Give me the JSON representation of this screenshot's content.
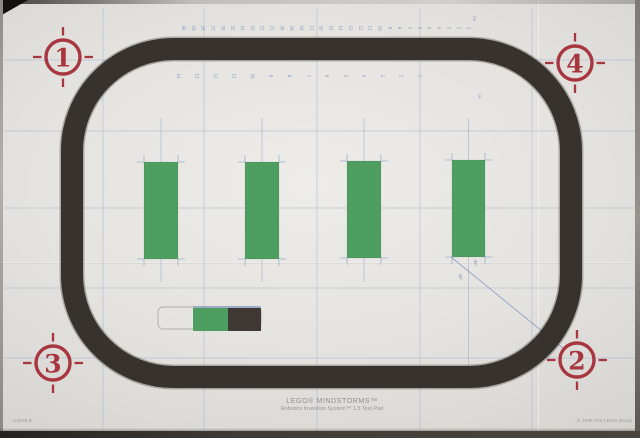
{
  "mat": {
    "title": {
      "line1": "LEGO® MINDSTORMS™",
      "line2": "Robotics Invention System™ 1.5 Test Pad"
    },
    "footer": {
      "left": "C1578 B",
      "right": "© 1998 The LEGO Group"
    },
    "colors": {
      "mat": "#e6e4e0",
      "track": "#37322e",
      "green": "#4f9e61",
      "dark_block": "#3f3835",
      "red": "#a8363e",
      "blue": "#7d93bd",
      "grid": "#8fa6c9",
      "text_gray": "#8f8d89"
    },
    "track": {
      "x": 72,
      "y": 49,
      "w": 499,
      "h": 328,
      "rx": 102,
      "stroke": 22
    },
    "grid": {
      "v": [
        103,
        204,
        317,
        420,
        532
      ],
      "h": [
        60,
        131,
        208,
        288,
        358
      ]
    },
    "ruler_top": {
      "y": 28,
      "x_start": 182,
      "x_end": 467,
      "unit": "cm",
      "unit_x": 473,
      "unit_y": 18,
      "numbers": [
        "30",
        "29",
        "28",
        "27",
        "26",
        "25",
        "24",
        "23",
        "22",
        "21",
        "20",
        "19",
        "18",
        "17",
        "16",
        "15",
        "14",
        "13",
        "12",
        "11",
        "10",
        "9",
        "8",
        "7",
        "6",
        "5",
        "4",
        "3",
        "2",
        "1"
      ]
    },
    "ruler_inner": {
      "y": 76,
      "x_start": 177,
      "x_end": 418,
      "unit": "in",
      "unit_x": 478,
      "unit_y": 96,
      "numbers": [
        "14",
        "13",
        "12",
        "11",
        "10",
        "9",
        "8",
        "7",
        "6",
        "5",
        "4",
        "3",
        "2",
        "1"
      ]
    },
    "bars": [
      {
        "x": 144,
        "y": 162,
        "w": 34,
        "h": 97,
        "line_y1": 118,
        "line_y2": 282
      },
      {
        "x": 245,
        "y": 162,
        "w": 34,
        "h": 97,
        "line_y1": 118,
        "line_y2": 282
      },
      {
        "x": 347,
        "y": 161,
        "w": 34,
        "h": 97,
        "line_y1": 118,
        "line_y2": 282
      },
      {
        "x": 452,
        "y": 160,
        "w": 33,
        "h": 97,
        "line_y1": 118,
        "line_y2": 372
      }
    ],
    "start_box": {
      "outline": {
        "x": 158,
        "y": 307,
        "w": 103,
        "h": 22,
        "r": 5
      },
      "green": {
        "x": 193,
        "y": 308,
        "w": 35,
        "h": 23
      },
      "dark": {
        "x": 228,
        "y": 308,
        "w": 33,
        "h": 23
      },
      "top_line": {
        "x1": 193,
        "x2": 261,
        "y": 307
      }
    },
    "diagonal": {
      "x1": 451,
      "y1": 257,
      "x2": 564,
      "y2": 349,
      "labels": [
        {
          "text": "45°",
          "x": 474,
          "y": 263,
          "rot": 90
        },
        {
          "text": "45°",
          "x": 459,
          "y": 277,
          "rot": 90
        }
      ]
    },
    "corner_markers": [
      {
        "label": "1",
        "cx": 63,
        "cy": 57
      },
      {
        "label": "2",
        "cx": 577,
        "cy": 360
      },
      {
        "label": "3",
        "cx": 53,
        "cy": 363
      },
      {
        "label": "4",
        "cx": 575,
        "cy": 63
      }
    ]
  }
}
